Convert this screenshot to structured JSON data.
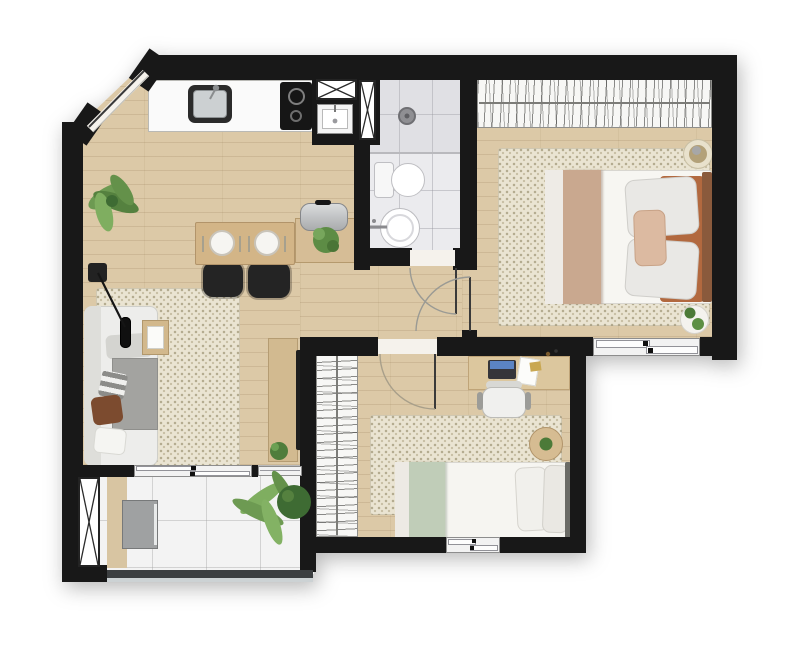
{
  "title": "Apartment floor plan - top-down furnished render",
  "rooms": {
    "kitchen": {
      "label": "Kitchen and dining area with counter, sink, cooktop, laundry tank, dining table for two and sideboard"
    },
    "living": {
      "label": "Living room with sofa, floor lamp, side table, rug and TV console"
    },
    "bathroom": {
      "label": "Bathroom with shower, toilet and round washbasin"
    },
    "hall": {
      "label": "Hallway connecting bathroom and bedrooms"
    },
    "bedroom1": {
      "label": "Bedroom 1 with wardrobe, double bed, pouf and bedside table"
    },
    "bedroom2": {
      "label": "Bedroom 2 with wardrobe, desk, office chair, round table and single bed"
    },
    "balcony": {
      "label": "Balcony with laundry counter, washing machine, palm plant and glass railing"
    }
  },
  "fixtures": {
    "entry_door": {
      "label": "Entry door on chamfered corner wall"
    },
    "bathroom_door": {
      "label": "Bathroom door with swing arc"
    },
    "bedroom1_door": {
      "label": "Bedroom 1 door with swing arc"
    },
    "bedroom2_door": {
      "label": "Bedroom 2 door with swing arc"
    },
    "balcony_slider": {
      "label": "Sliding glass door to balcony"
    },
    "window_bed1": {
      "label": "Sliding window of bedroom 1"
    },
    "window_bed2": {
      "label": "Sliding window of bedroom 2"
    },
    "shafts": {
      "label": "Ventilation shaft marked with X"
    }
  },
  "furniture": {
    "kitchen": [
      "counter with stainless sink",
      "two-burner cooktop",
      "laundry tank",
      "dining table",
      "two plates with cutlery",
      "two black chairs",
      "sideboard with kettle and plant",
      "corner plant"
    ],
    "living": [
      "three-seat sofa",
      "gray throw",
      "checkered pillow",
      "brown pillow",
      "white pillow",
      "floor lamp",
      "wood side table",
      "dotted rug",
      "TV console",
      "flat TV",
      "potted plant"
    ],
    "bathroom": [
      "walk-in shower with drain",
      "toilet",
      "round washbasin with wall faucet"
    ],
    "bedroom1": [
      "full-width wardrobe with hanging clothes",
      "double bed with tan runner",
      "rust headboard",
      "gray pillows",
      "blush pillow",
      "round pouf",
      "round bedside table with plants",
      "dotted rug"
    ],
    "bedroom2": [
      "tall wardrobe with hanging clothes",
      "desk with laptop and papers",
      "white office chair",
      "round side table with plant",
      "single bed with sage runner",
      "white pillows",
      "dotted rug"
    ],
    "balcony": [
      "wood laundry counter",
      "washing machine",
      "large palm plant",
      "glass guard rail"
    ]
  },
  "palette": {
    "wall": "#181818",
    "wood_floor": "#dcc9a7",
    "rug": "#eae4d2",
    "bathroom_tile": "#ebebee",
    "balcony_tile": "#f3f3f3",
    "counter_white": "#fafafa",
    "appliance_black": "#1c1c1c",
    "steel": "#c9ccce",
    "table_wood": "#d3b587",
    "blanket_tan": "#c9a88f",
    "accent_rust": "#b2693f",
    "accent_blush": "#dcbaa1",
    "accent_sage": "#c0cdb8",
    "plant_green": "#5d8f44",
    "plant_dark": "#3e6b33",
    "railing_glass": "#ccd2d4"
  }
}
